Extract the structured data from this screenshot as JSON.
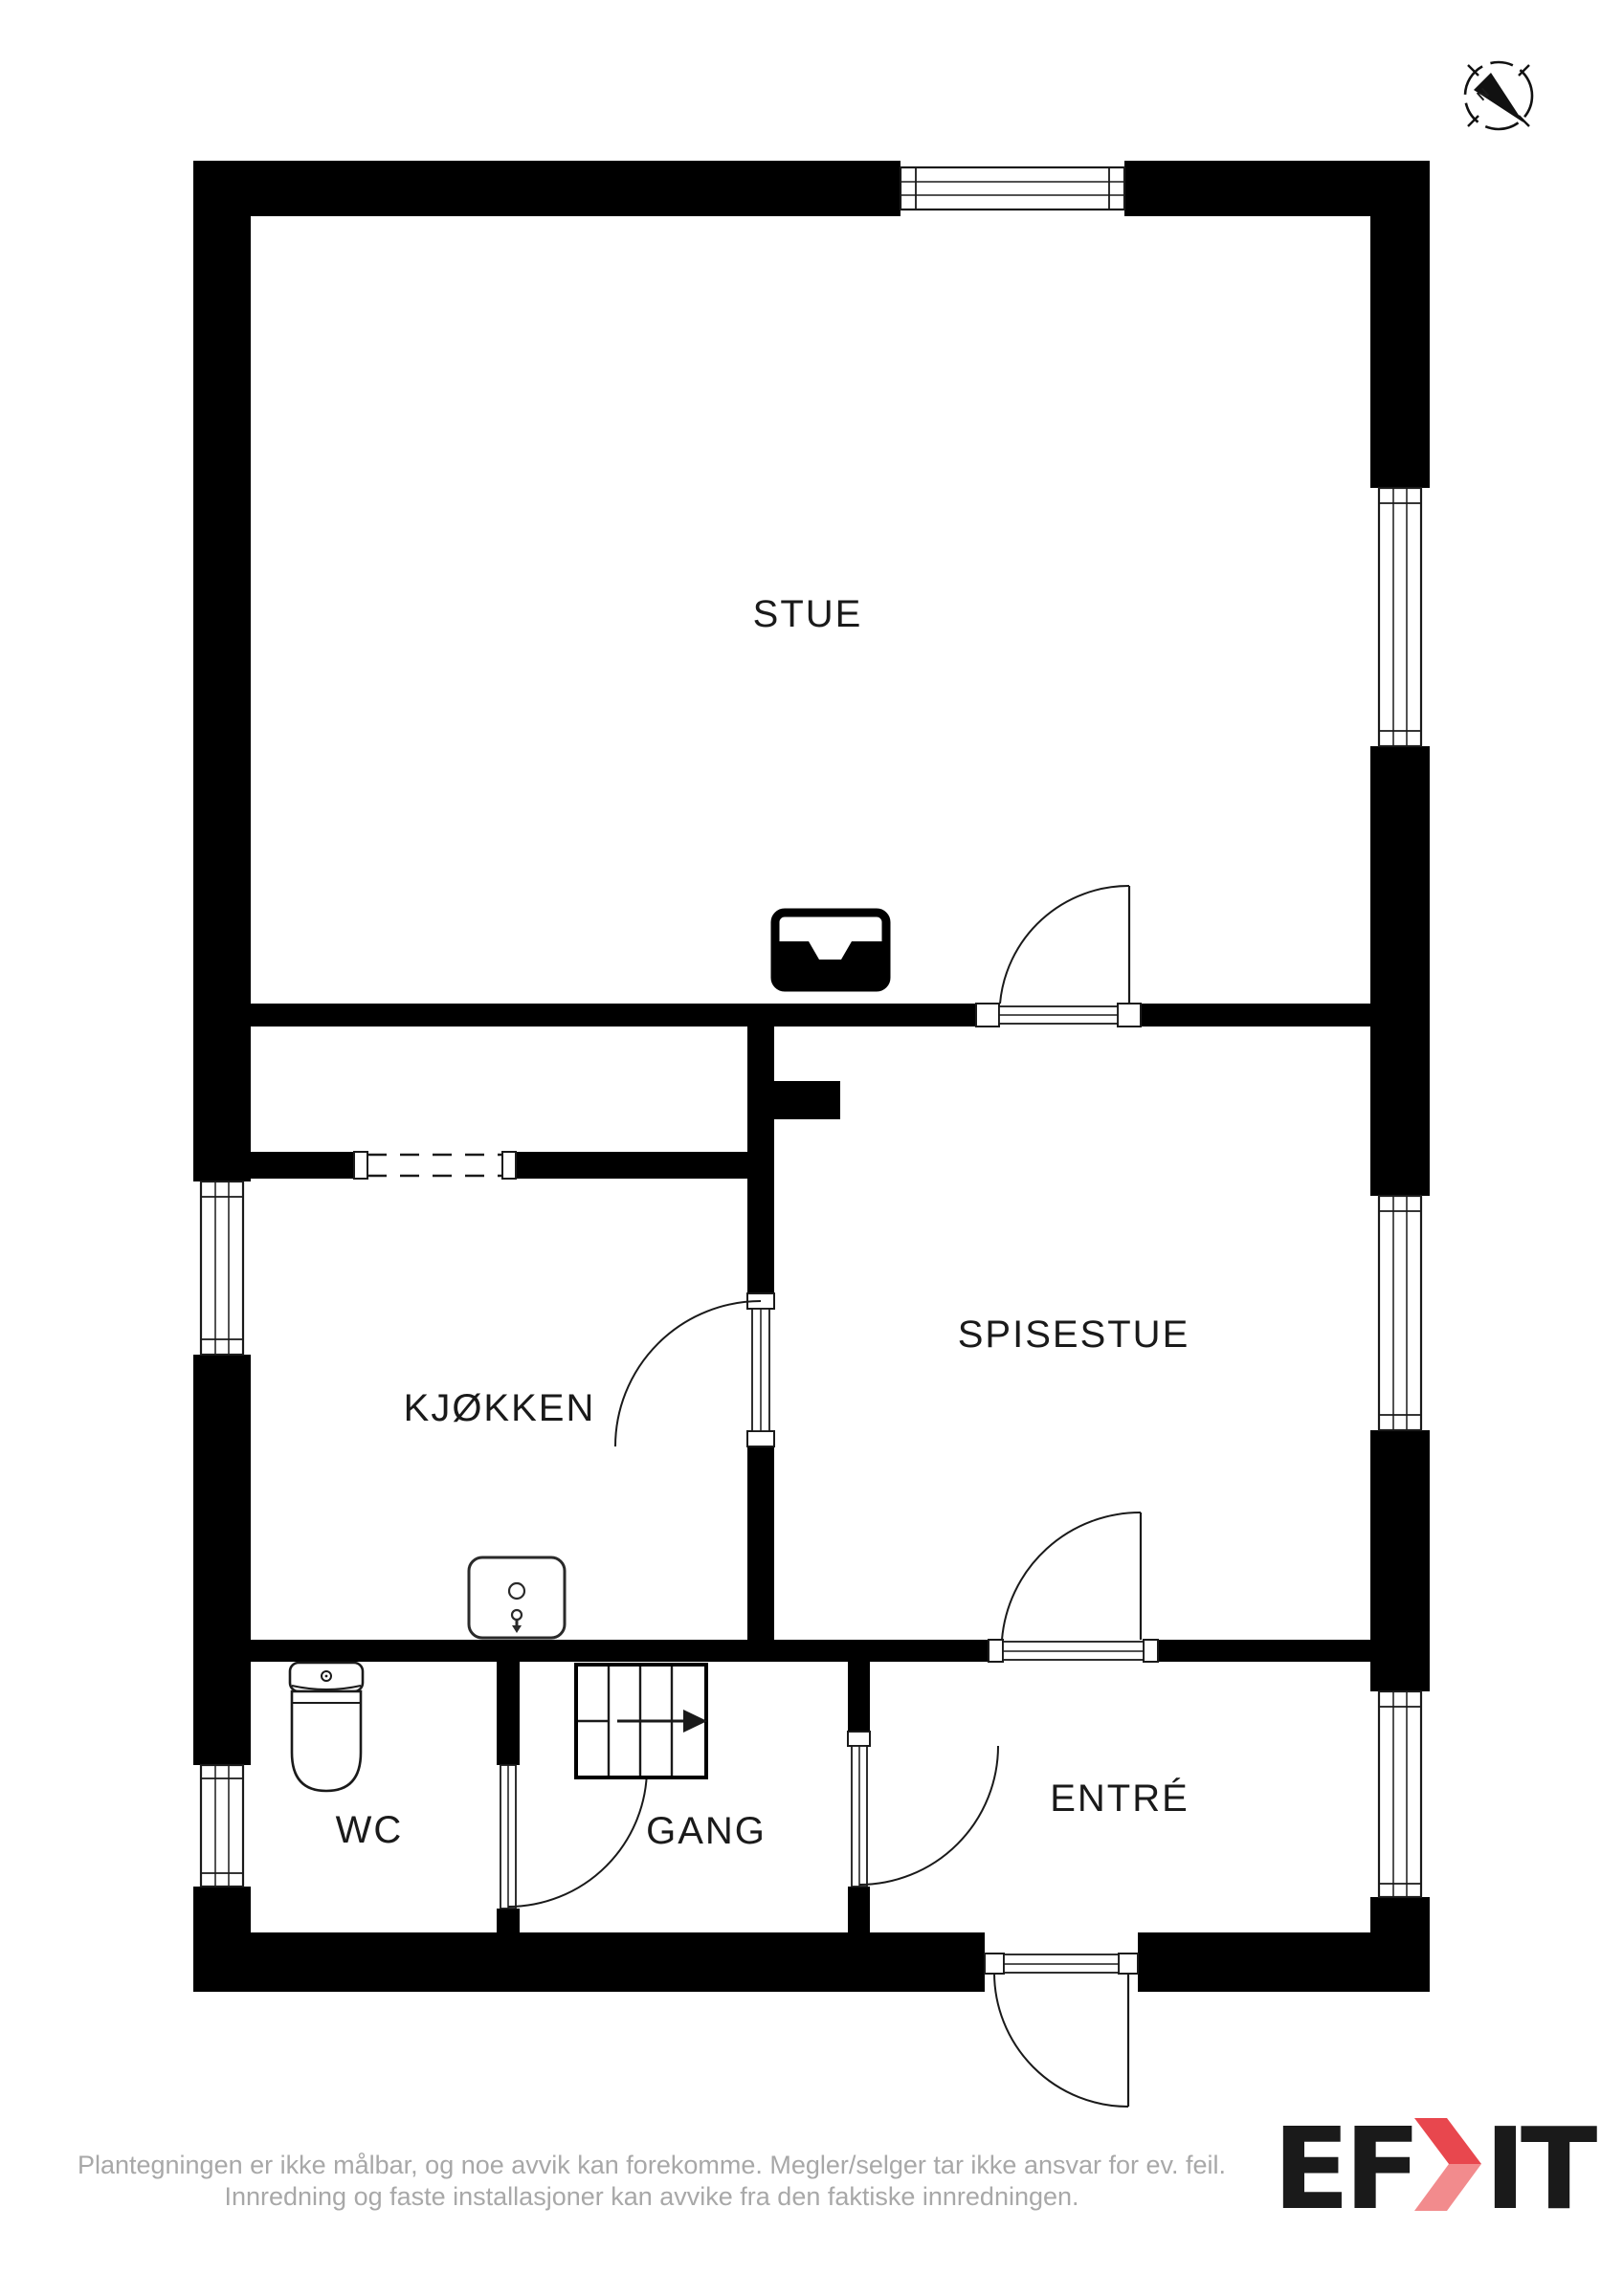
{
  "compass": {
    "north_label": "N"
  },
  "rooms": {
    "stue": {
      "label": "STUE"
    },
    "spisestue": {
      "label": "SPISESTUE"
    },
    "kjokken": {
      "label": "KJØKKEN"
    },
    "wc": {
      "label": "WC"
    },
    "gang": {
      "label": "GANG"
    },
    "entre": {
      "label": "ENTRÉ"
    }
  },
  "icons": {
    "fireplace": "fireplace-icon",
    "water_heater": "water-heater-icon",
    "toilet": "toilet-icon",
    "stairs": "stairs-icon",
    "compass": "compass-icon"
  },
  "disclaimer": {
    "line1": "Plantegningen er ikke målbar, og noe avvik kan forekomme. Megler/selger tar ikke ansvar for ev. feil.",
    "line2": "Innredning og faste installasjoner kan avvike fra den faktiske innredningen."
  },
  "logo": {
    "text_left": "EF",
    "text_right": "IT",
    "brand": "EFKT"
  },
  "colors": {
    "wall": "#000000",
    "line": "#1a1a1a",
    "label_text": "#1a1a1a",
    "disclaimer_text": "#a8a8a8",
    "logo_navy": "#343a56",
    "logo_red": "#e8474e",
    "logo_red_light": "#f28b8d"
  }
}
